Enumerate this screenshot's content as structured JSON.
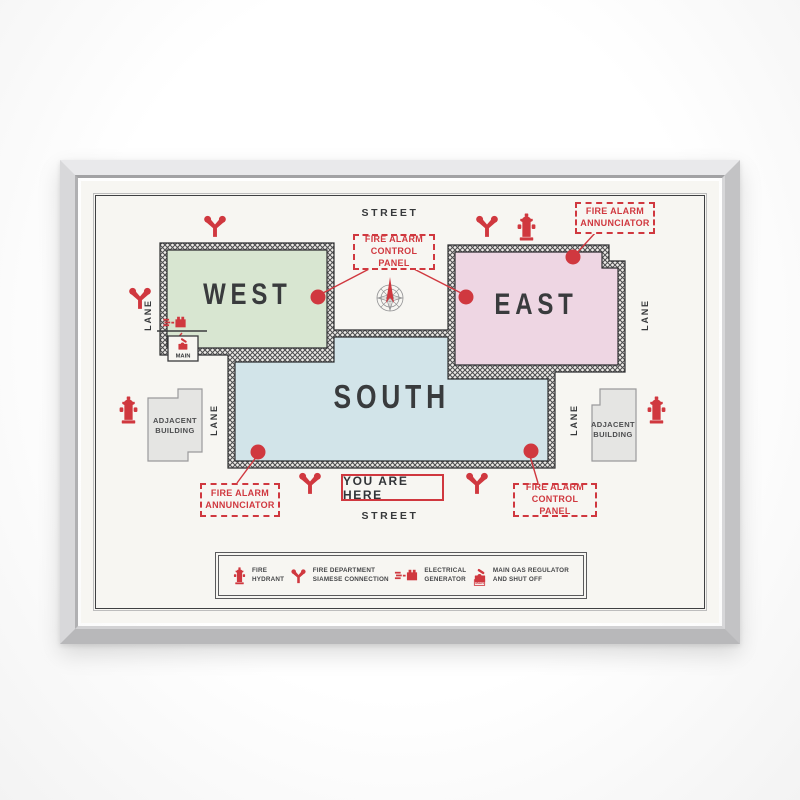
{
  "map": {
    "street_top": "STREET",
    "street_bottom": "STREET",
    "lane_outer_left": "LANE",
    "lane_outer_right": "LANE",
    "lane_inner_left": "LANE",
    "lane_inner_right": "LANE",
    "buildings": {
      "west": "WEST",
      "east": "EAST",
      "south": "SOUTH"
    },
    "adjacent_left": {
      "line1": "ADJACENT",
      "line2": "BUILDING"
    },
    "adjacent_right": {
      "line1": "ADJACENT",
      "line2": "BUILDING"
    },
    "callouts": {
      "top_panel": {
        "line1": "FIRE ALARM",
        "line2": "CONTROL PANEL"
      },
      "top_annunciator": {
        "line1": "FIRE ALARM",
        "line2": "ANNUNCIATOR"
      },
      "bottom_annunciator": {
        "line1": "FIRE ALARM",
        "line2": "ANNUNCIATOR"
      },
      "bottom_panel": {
        "line1": "FIRE ALARM",
        "line2": "CONTROL PANEL"
      }
    },
    "you_are_here": "YOU ARE HERE",
    "main_tag": "MAIN"
  },
  "legend": {
    "items": [
      {
        "icon": "fire-hydrant-icon",
        "line1": "FIRE",
        "line2": "HYDRANT"
      },
      {
        "icon": "siamese-connection-icon",
        "line1": "FIRE DEPARTMENT",
        "line2": "SIAMESE CONNECTION"
      },
      {
        "icon": "electrical-generator-icon",
        "line1": "ELECTRICAL",
        "line2": "GENERATOR"
      },
      {
        "icon": "gas-regulator-icon",
        "line1": "MAIN GAS REGULATOR",
        "line2": "AND SHUT OFF"
      }
    ]
  },
  "colors": {
    "accent_red": "#d0383f",
    "west_green": "#d8e6d1",
    "east_pink": "#eed6e3",
    "south_blue": "#d2e4e9",
    "ink": "#37393b",
    "frame_silver": "#cdcdcf",
    "poster": "#f7f6f2"
  }
}
